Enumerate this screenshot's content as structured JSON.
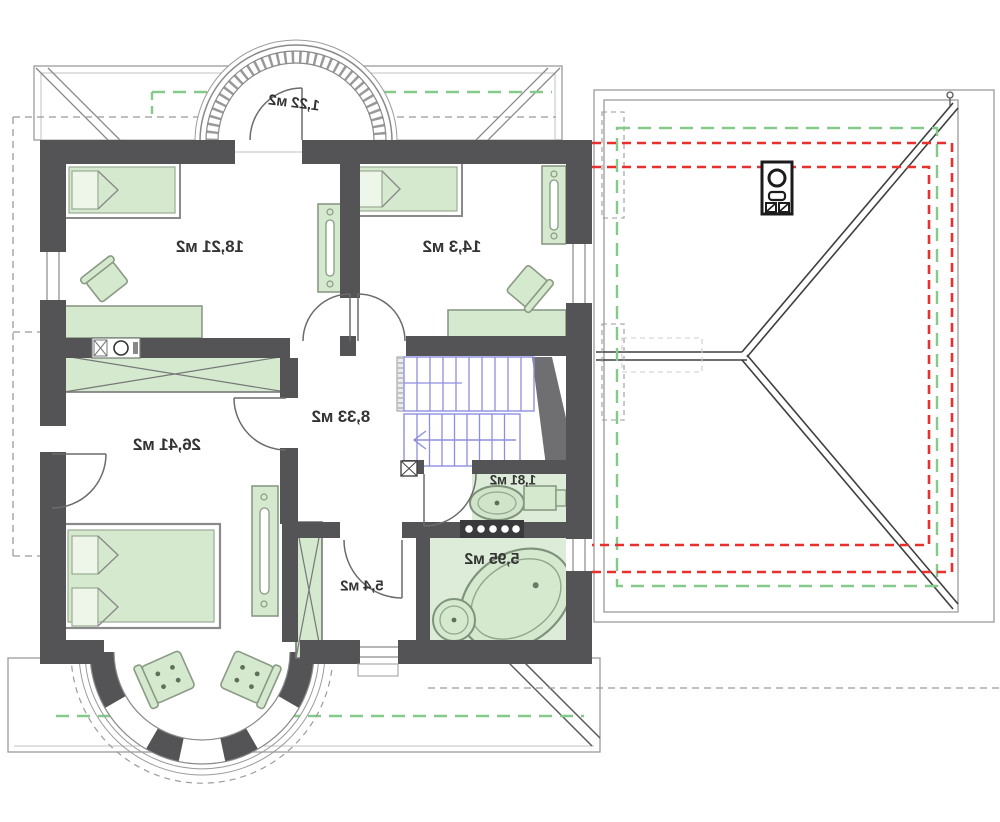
{
  "plan": {
    "type": "floor-plan",
    "mirrored_text": true,
    "rooms": [
      {
        "id": "balcony",
        "area_label": "1,22 м2"
      },
      {
        "id": "bedroom-top-left",
        "area_label": "18,21 м2"
      },
      {
        "id": "bedroom-top-right",
        "area_label": "14,3 м2"
      },
      {
        "id": "hall-landing",
        "area_label": "8,33 м2"
      },
      {
        "id": "bedroom-bottom-left",
        "area_label": "26,41 м2"
      },
      {
        "id": "wc",
        "area_label": "1,81 м2"
      },
      {
        "id": "dressing-room",
        "area_label": "5,4 м2"
      },
      {
        "id": "bathroom",
        "area_label": "5,95 м2"
      }
    ],
    "colors": {
      "wall": "#545456",
      "furniture_fill": "#d5e9cf",
      "floor_tint": "#dcecd8",
      "stairs_blue": "#8f8fe0",
      "roof_dashed_green": "#85c98b",
      "overlay_dashed_red": "#e8312e",
      "outline_gray": "#9b9b9b"
    }
  }
}
